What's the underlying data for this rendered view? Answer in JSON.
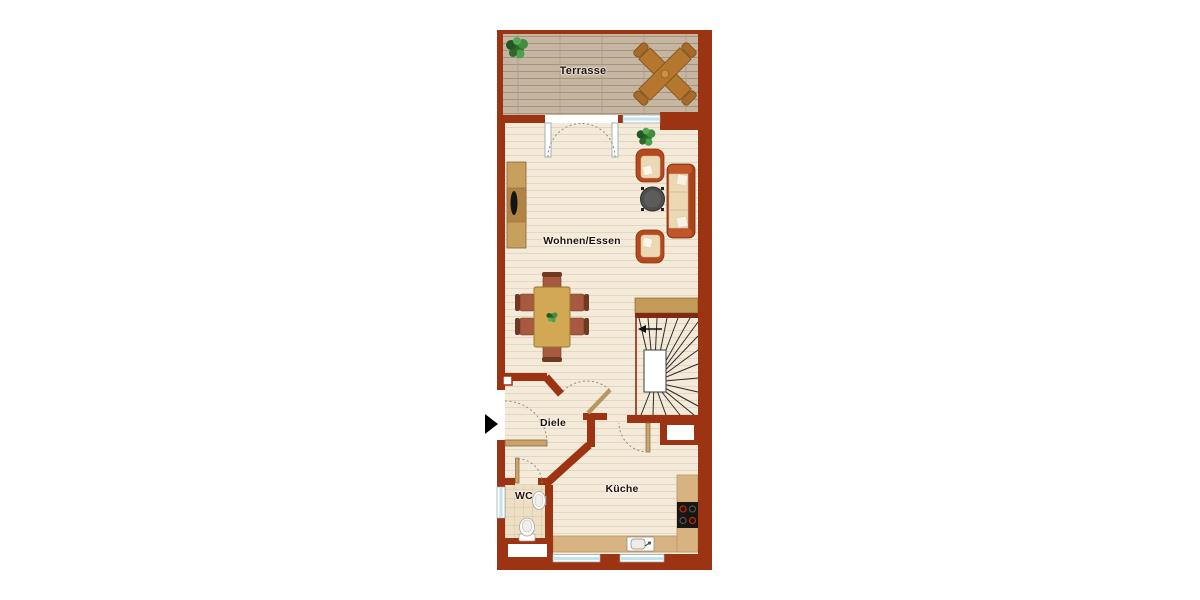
{
  "page": {
    "background": "#ffffff",
    "type": "floor-plan"
  },
  "floor_plan": {
    "rooms": {
      "terrace": {
        "label": "Terrasse"
      },
      "living_dining": {
        "label": "Wohnen/Essen"
      },
      "hallway": {
        "label": "Diele"
      },
      "wc": {
        "label": "WC"
      },
      "kitchen": {
        "label": "Küche"
      }
    },
    "colors": {
      "wall": "#9c3312",
      "floor": "#f4ead9",
      "terrace_deck": "#c6b5a0",
      "wc_tiles": "#ecdfc4",
      "kitchen_counter": "#d6b381",
      "window_glass": "#c2e2ec",
      "door_leaf": "#c9a36b",
      "wood_furniture": "#c49a58",
      "upholstery": "#b5491d",
      "cushion": "#ecd9b4"
    },
    "furniture": [
      "potted-plant",
      "terrace-table",
      "double-terrace-door",
      "sideboard-with-tv",
      "armchair",
      "sofa",
      "coffee-table",
      "dining-table-six-chairs",
      "winder-staircase",
      "entrance-arrow",
      "wc-toilet",
      "wash-basin",
      "kitchen-counter",
      "stove",
      "kitchen-sink"
    ]
  }
}
